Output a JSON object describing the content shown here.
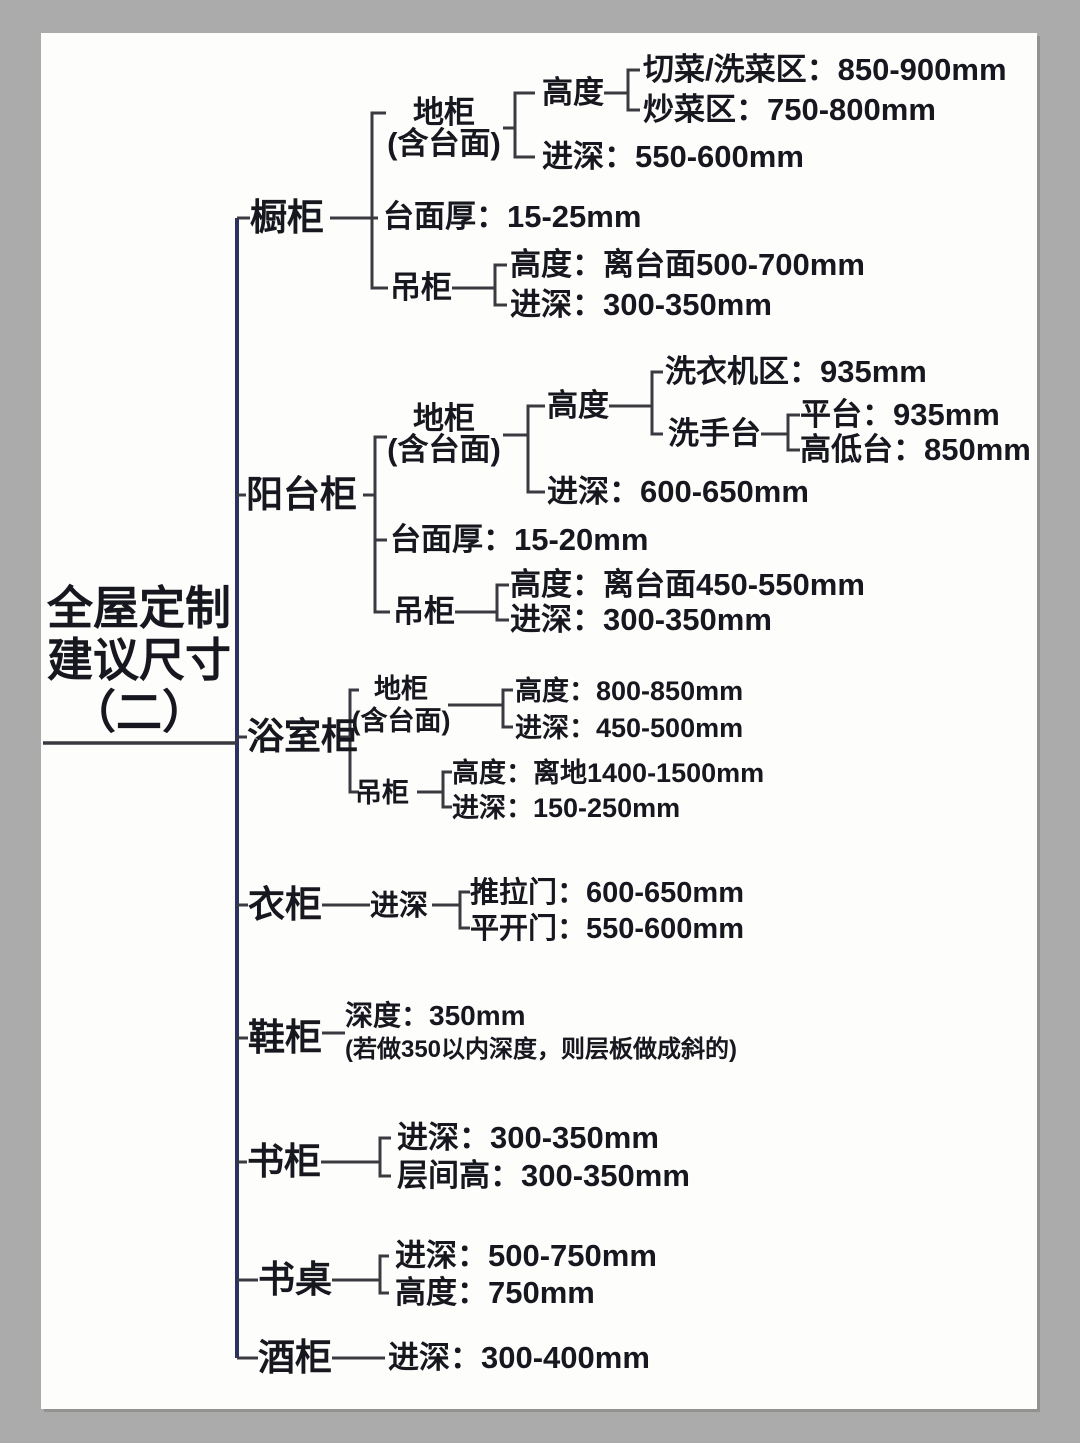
{
  "colors": {
    "frame_bg": "#ababab",
    "paper_bg": "#fdfdfb",
    "text": "#17171f",
    "trunk_line": "#2c3362",
    "branch_line": "#3a3a40"
  },
  "root": {
    "title_line1": "全屋定制",
    "title_line2": "建议尺寸",
    "title_line3": "（二）"
  },
  "branches": {
    "chugui": {
      "label": "橱柜",
      "digui": {
        "line1": "地柜",
        "line2": "(含台面)",
        "gaodu": {
          "label": "高度",
          "qiecai": "切菜/洗菜区：850-900mm",
          "chaocai": "炒菜区：750-800mm"
        },
        "jinshen": "进深：550-600mm"
      },
      "taimianhou": "台面厚：15-25mm",
      "diaogui": {
        "label": "吊柜",
        "gaodu": "高度：离台面500-700mm",
        "jinshen": "进深：300-350mm"
      }
    },
    "yangtaigui": {
      "label": "阳台柜",
      "digui": {
        "line1": "地柜",
        "line2": "(含台面)",
        "gaodu": {
          "label": "高度",
          "xiyiji": "洗衣机区：935mm",
          "xishoutai": {
            "label": "洗手台",
            "pingtai": "平台：935mm",
            "gaoditai": "高低台：850mm"
          }
        },
        "jinshen": "进深：600-650mm"
      },
      "taimianhou": "台面厚：15-20mm",
      "diaogui": {
        "label": "吊柜",
        "gaodu": "高度：离台面450-550mm",
        "jinshen": "进深：300-350mm"
      }
    },
    "yushigui": {
      "label": "浴室柜",
      "digui": {
        "line1": "地柜",
        "line2": "(含台面)",
        "gaodu": "高度：800-850mm",
        "jinshen": "进深：450-500mm"
      },
      "diaogui": {
        "label": "吊柜",
        "gaodu": "高度：离地1400-1500mm",
        "jinshen": "进深：150-250mm"
      }
    },
    "yigui": {
      "label": "衣柜",
      "jinshen": {
        "label": "进深",
        "tuilamen": "推拉门：600-650mm",
        "pingkaimen": "平开门：550-600mm"
      }
    },
    "xiegui": {
      "label": "鞋柜",
      "shendu": "深度：350mm",
      "note": "(若做350以内深度，则层板做成斜的)"
    },
    "shugui": {
      "label": "书柜",
      "jinshen": "进深：300-350mm",
      "cengjiangao": "层间高：300-350mm"
    },
    "shuzhuo": {
      "label": "书桌",
      "jinshen": "进深：500-750mm",
      "gaodu": "高度：750mm"
    },
    "jiugui": {
      "label": "酒柜",
      "jinshen": "进深：300-400mm"
    }
  }
}
